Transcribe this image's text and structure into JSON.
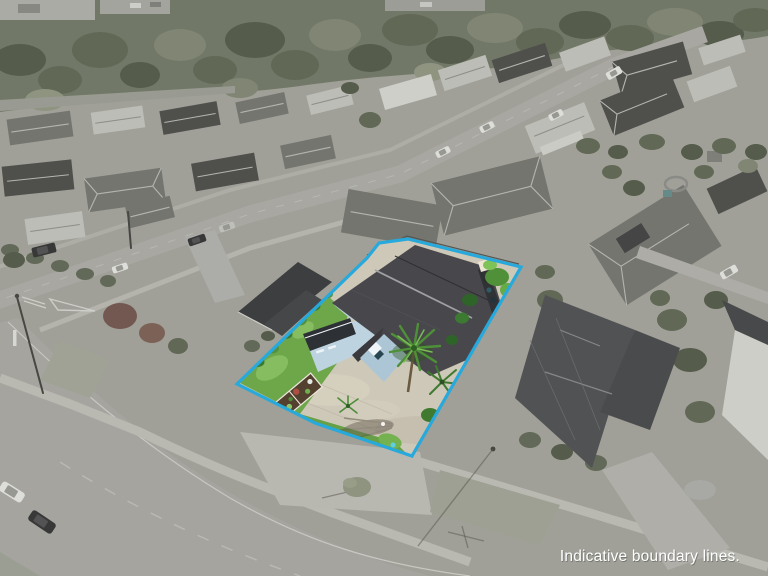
{
  "caption": {
    "text": "Indicative boundary lines.",
    "color": "#ffffff",
    "shadow_color": "rgba(40,40,40,0.35)"
  },
  "boundary": {
    "color": "#28a9db",
    "stroke_width": 3.2,
    "points": "237,384 367,258 379,243 408,239 521,267 412,456 315,423"
  },
  "palette": {
    "background_ground": "#a4a49b",
    "desaturation_wash": "#8d9084",
    "forest": "#6e7562",
    "road": "#a9a8a3",
    "lot_concrete": "#cec8b9",
    "lot_lawn": "#6da74a",
    "house_wall": "#bed3e0",
    "house_roof": "#48484c"
  },
  "scene": {
    "subject": "highlighted-residential-lot",
    "background": "desaturated-suburb-with-forest"
  }
}
